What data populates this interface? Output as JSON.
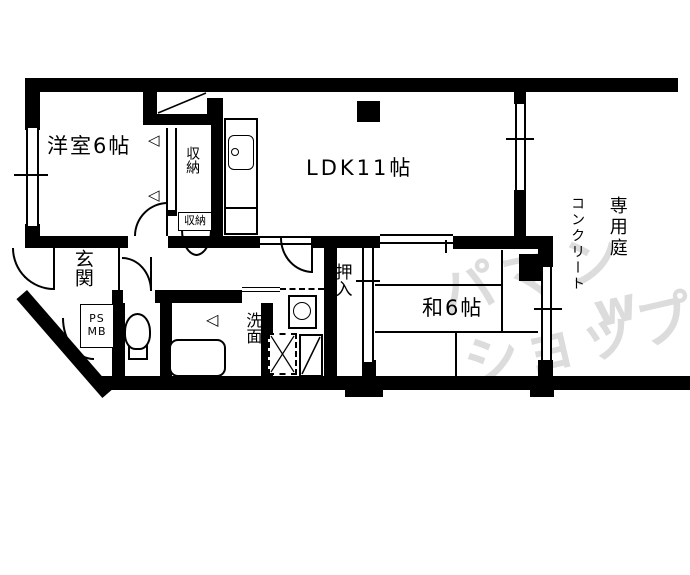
{
  "plan": {
    "labels": {
      "western_room": "洋室6帖",
      "ldk": "LDK11帖",
      "japanese_room": "和6帖",
      "entrance": "玄関",
      "closet": "収納",
      "closet_small": "収納",
      "oshiire": "押入",
      "washroom": "洗面",
      "ps": "PS",
      "mb": "MB",
      "garden": "専用庭",
      "garden_surface": "コンクリート"
    },
    "watermark": {
      "brand": "アパマンショップ",
      "line1": "パマン",
      "line2": "ショップ",
      "mark": "w"
    },
    "icons": {
      "folding_marker": "◁"
    },
    "colors": {
      "wall": "#000000",
      "background": "#ffffff",
      "watermark": "#dcdcdc"
    }
  }
}
